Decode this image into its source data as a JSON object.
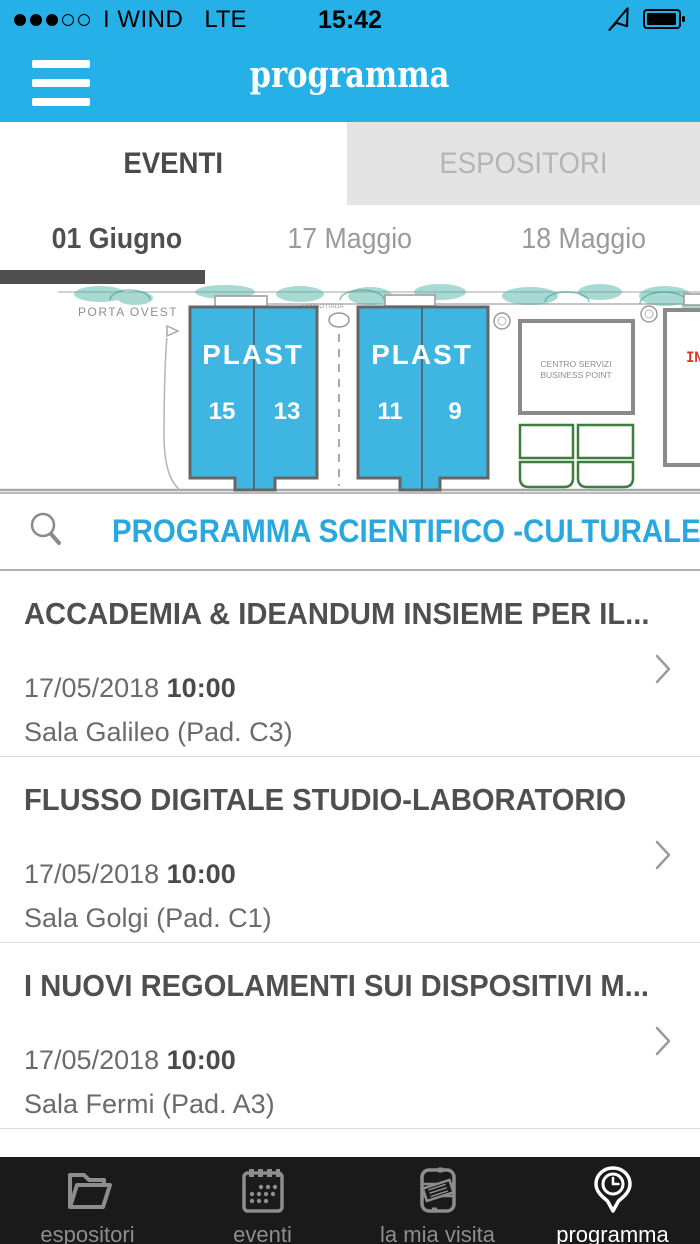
{
  "colors": {
    "header_bg": "#25b1e7",
    "hall_fill": "#3fb5e2",
    "search_text": "#29a8df",
    "tree_teal": "#53b5a9",
    "active_text": "#4f4f4f",
    "secondary_text": "#6b6b6b",
    "inactive_text": "#9a9a9a",
    "inactive_tab_bg": "#e4e4e4",
    "bottom_bar_bg": "#1a1a1a",
    "bottom_inactive": "#8d8d8d",
    "map_red_label": "#e03024",
    "green_outline": "#3e7d3c"
  },
  "status_bar": {
    "signal": "3 of 5 dots",
    "carrier": "I WIND",
    "network": "LTE",
    "time": "15:42"
  },
  "app_bar": {
    "title": "programma"
  },
  "tabs": [
    {
      "label": "EVENTI",
      "active": true
    },
    {
      "label": "ESPOSITORI",
      "active": false
    }
  ],
  "dates": [
    {
      "label": "01 Giugno",
      "active": true
    },
    {
      "label": "17 Maggio",
      "active": false
    },
    {
      "label": "18 Maggio",
      "active": false
    }
  ],
  "map": {
    "porta_ovest": "PORTA OVEST",
    "road_label": "CORSO ITALIA",
    "buildings": [
      {
        "name": "PLAST",
        "halls": [
          "15",
          "13"
        ]
      },
      {
        "name": "PLAST",
        "halls": [
          "11",
          "9"
        ]
      }
    ],
    "service_line1": "CENTRO SERVIZI",
    "service_line2": "BUSINESS POINT",
    "partial_label": "IN"
  },
  "search": {
    "label": "PROGRAMMA SCIENTIFICO -CULTURALE"
  },
  "events": [
    {
      "title": "ACCADEMIA & IDEANDUM INSIEME PER IL...",
      "date": "17/05/2018",
      "time": "10:00",
      "location": "Sala Galileo (Pad. C3)"
    },
    {
      "title": "FLUSSO DIGITALE STUDIO-LABORATORIO",
      "date": "17/05/2018",
      "time": "10:00",
      "location": "Sala Golgi (Pad. C1)"
    },
    {
      "title": "I NUOVI REGOLAMENTI SUI DISPOSITIVI M...",
      "date": "17/05/2018",
      "time": "10:00",
      "location": "Sala Fermi (Pad. A3)"
    }
  ],
  "tab_bar": [
    {
      "label": "espositori",
      "icon": "folder-icon",
      "active": false
    },
    {
      "label": "eventi",
      "icon": "calendar-icon",
      "active": false
    },
    {
      "label": "la mia visita",
      "icon": "visit-notes-icon",
      "active": false
    },
    {
      "label": "programma",
      "icon": "clock-pin-icon",
      "active": true
    }
  ]
}
